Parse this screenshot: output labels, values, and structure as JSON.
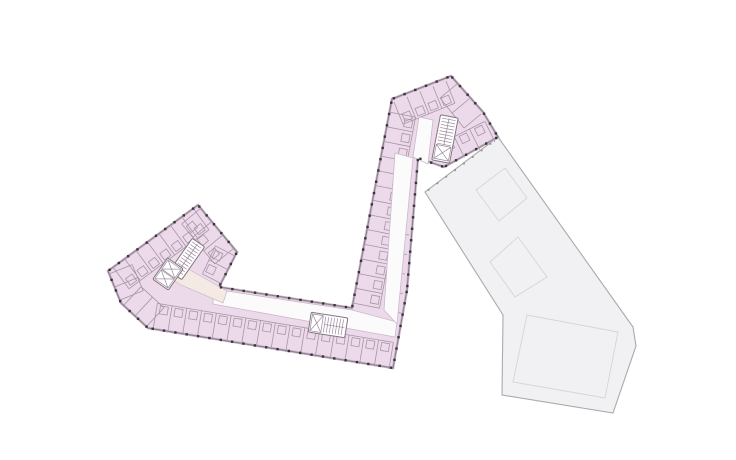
{
  "meta": {
    "title": "Architectural floor plan drawing",
    "description": "Angular J-shaped residential floor plan (pink) with adjoining grey roof wing",
    "width": 736,
    "height": 460
  },
  "colors": {
    "background": "#ffffff",
    "pink_fill": "#ecdaea",
    "pink_outline": "#8a7a8a",
    "pink_halo": "#c8b8c8",
    "room_line": "#a795a8",
    "corridor_fill": "#fcfbfc",
    "corridor_line": "#c9bac9",
    "lobby_fill": "#f5e9e4",
    "core_fill": "#ffffff",
    "core_line": "#857585",
    "core_inner_line": "#9a8a9a",
    "column_dot": "#3a333f",
    "gray_fill": "#f1f1f3",
    "gray_outline": "#aaaaae",
    "gray_inner_line": "#d5d5d9",
    "gray_tick": "#909095"
  },
  "gray_wing": {
    "outline": [
      [
        498,
        137
      ],
      [
        633,
        327
      ],
      [
        636,
        346
      ],
      [
        613,
        413
      ],
      [
        502,
        395
      ],
      [
        503,
        315
      ],
      [
        425,
        192
      ]
    ],
    "inner_squares": [
      [
        [
          505,
          168
        ],
        [
          527,
          198
        ],
        [
          499,
          221
        ],
        [
          476,
          190
        ]
      ],
      [
        [
          518,
          237
        ],
        [
          547,
          277
        ],
        [
          515,
          297
        ],
        [
          490,
          262
        ]
      ],
      [
        [
          527,
          315
        ],
        [
          618,
          332
        ],
        [
          605,
          398
        ],
        [
          513,
          382
        ]
      ]
    ],
    "tick_edge": [
      [
        427,
        191
      ],
      [
        497,
        139
      ]
    ],
    "tick_spacing": 11,
    "tick_size": 1.8
  },
  "pink_building": {
    "outline": [
      [
        451,
        76
      ],
      [
        483,
        112
      ],
      [
        498,
        137
      ],
      [
        444,
        167
      ],
      [
        418,
        158
      ],
      [
        407,
        290
      ],
      [
        393,
        368
      ],
      [
        148,
        328
      ],
      [
        121,
        303
      ],
      [
        108,
        271
      ],
      [
        198,
        205
      ],
      [
        237,
        252
      ],
      [
        219,
        287
      ],
      [
        352,
        308
      ],
      [
        392,
        99
      ]
    ],
    "dot_spacing": 11.5,
    "dot_size": 2.4,
    "corridors": [
      {
        "name": "corridor-south-wing",
        "pts": [
          [
            213,
            289
          ],
          [
            352,
            310
          ],
          [
            397,
            322
          ],
          [
            395,
            337
          ],
          [
            213,
            304
          ]
        ]
      },
      {
        "name": "corridor-diagonal-wing",
        "pts": [
          [
            395,
            153
          ],
          [
            413,
            158
          ],
          [
            397,
            324
          ],
          [
            384,
            310
          ]
        ]
      },
      {
        "name": "corridor-head-landing",
        "pts": [
          [
            419,
            117
          ],
          [
            433,
            120
          ],
          [
            428,
            164
          ],
          [
            413,
            157
          ]
        ]
      }
    ],
    "lobby": [
      [
        166,
        259
      ],
      [
        190,
        270
      ],
      [
        227,
        291
      ],
      [
        223,
        303
      ],
      [
        181,
        285
      ],
      [
        159,
        271
      ]
    ],
    "room_strips": [
      {
        "name": "rooms-south",
        "a": [
          153,
          330
        ],
        "b": [
          389,
          369
        ],
        "inward": [
          0.162,
          -0.987
        ],
        "depth": 27,
        "count": 17,
        "bath": true
      },
      {
        "name": "rooms-arm-west",
        "a": [
          389,
          112
        ],
        "b": [
          353,
          303
        ],
        "inward": [
          0.982,
          0.192
        ],
        "depth": 27,
        "count": 14,
        "bath": true
      },
      {
        "name": "rooms-left-nw",
        "a": [
          113,
          267
        ],
        "b": [
          193,
          208
        ],
        "inward": [
          0.591,
          0.806
        ],
        "depth": 27,
        "count": 8,
        "bath": true
      },
      {
        "name": "rooms-left-ne",
        "a": [
          201,
          208
        ],
        "b": [
          234,
          248
        ],
        "inward": [
          -0.77,
          0.639
        ],
        "depth": 25,
        "count": 4,
        "bath": true
      },
      {
        "name": "rooms-left-w",
        "a": [
          109,
          274
        ],
        "b": [
          120,
          300
        ],
        "inward": [
          0.928,
          -0.373
        ],
        "depth": 25,
        "count": 3,
        "bath": false
      },
      {
        "name": "rooms-left-s",
        "a": [
          124,
          305
        ],
        "b": [
          147,
          326
        ],
        "inward": [
          0.68,
          -0.733
        ],
        "depth": 25,
        "count": 3,
        "bath": false
      },
      {
        "name": "rooms-head-nw",
        "a": [
          394,
          102
        ],
        "b": [
          446,
          81
        ],
        "inward": [
          0.373,
          0.928
        ],
        "depth": 24,
        "count": 5,
        "bath": true
      },
      {
        "name": "rooms-head-e",
        "a": [
          495,
          142
        ],
        "b": [
          449,
          165
        ],
        "inward": [
          -0.44,
          -0.898
        ],
        "depth": 23,
        "count": 4,
        "bath": true
      },
      {
        "name": "rooms-arm-east",
        "a": [
          409,
          235
        ],
        "b": [
          401,
          313
        ],
        "inward": [
          -0.993,
          -0.119
        ],
        "depth": 7,
        "count": 5,
        "bath": false
      },
      {
        "name": "rooms-head-ne",
        "a": [
          457,
          84
        ],
        "b": [
          481,
          114
        ],
        "inward": [
          -0.77,
          0.638
        ],
        "depth": 22,
        "count": 3,
        "bath": false
      },
      {
        "name": "rooms-left-e",
        "a": [
          235,
          256
        ],
        "b": [
          222,
          284
        ],
        "inward": [
          -0.889,
          -0.457
        ],
        "depth": 22,
        "count": 3,
        "bath": true
      }
    ],
    "bath_size": 8,
    "cores": [
      {
        "name": "core-head-stair-elevator",
        "cx": 445,
        "cy": 139,
        "w": 18,
        "h": 46,
        "angle": 11,
        "type": "stair2-elev"
      },
      {
        "name": "core-left-stair",
        "cx": 187,
        "cy": 259,
        "w": 15,
        "h": 40,
        "angle": 35,
        "type": "stair2"
      },
      {
        "name": "core-left-elevators",
        "cx": 168,
        "cy": 274,
        "w": 19,
        "h": 26,
        "angle": 35,
        "type": "elev2"
      },
      {
        "name": "core-south-elevator-stair",
        "cx": 328,
        "cy": 325,
        "w": 37,
        "h": 20,
        "angle": 9,
        "type": "elev-stair-h"
      }
    ]
  }
}
